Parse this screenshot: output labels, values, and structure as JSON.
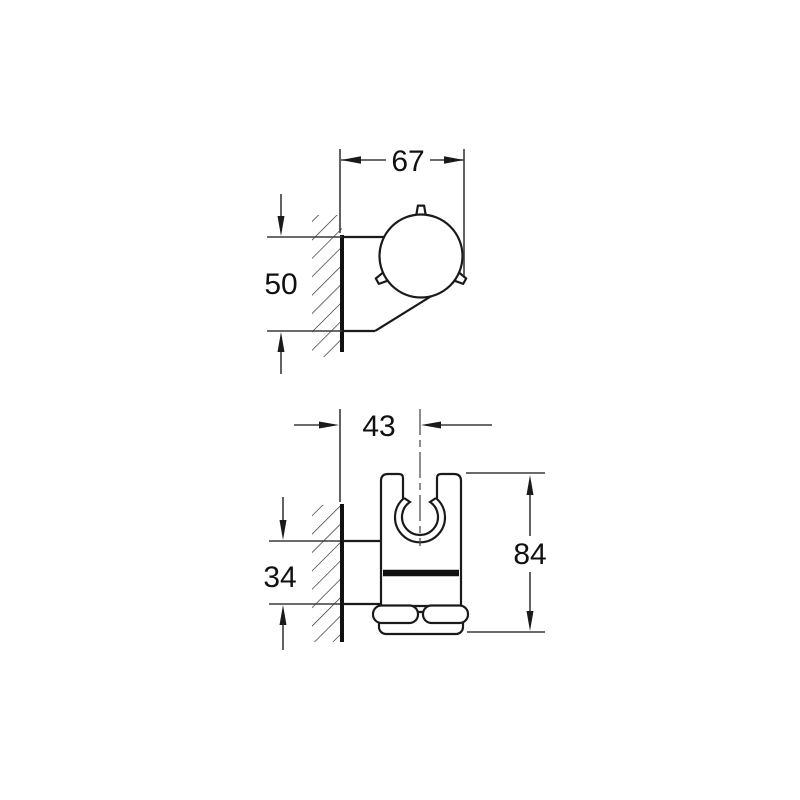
{
  "drawing": {
    "views": {
      "side": {
        "depth": "67",
        "height": "50"
      },
      "front": {
        "center_offset": "43",
        "bracket_height": "34",
        "overall_height": "84"
      }
    },
    "colors": {
      "line": "#1a1a1a",
      "dimension": "#3a3a3a",
      "background": "#ffffff"
    }
  }
}
